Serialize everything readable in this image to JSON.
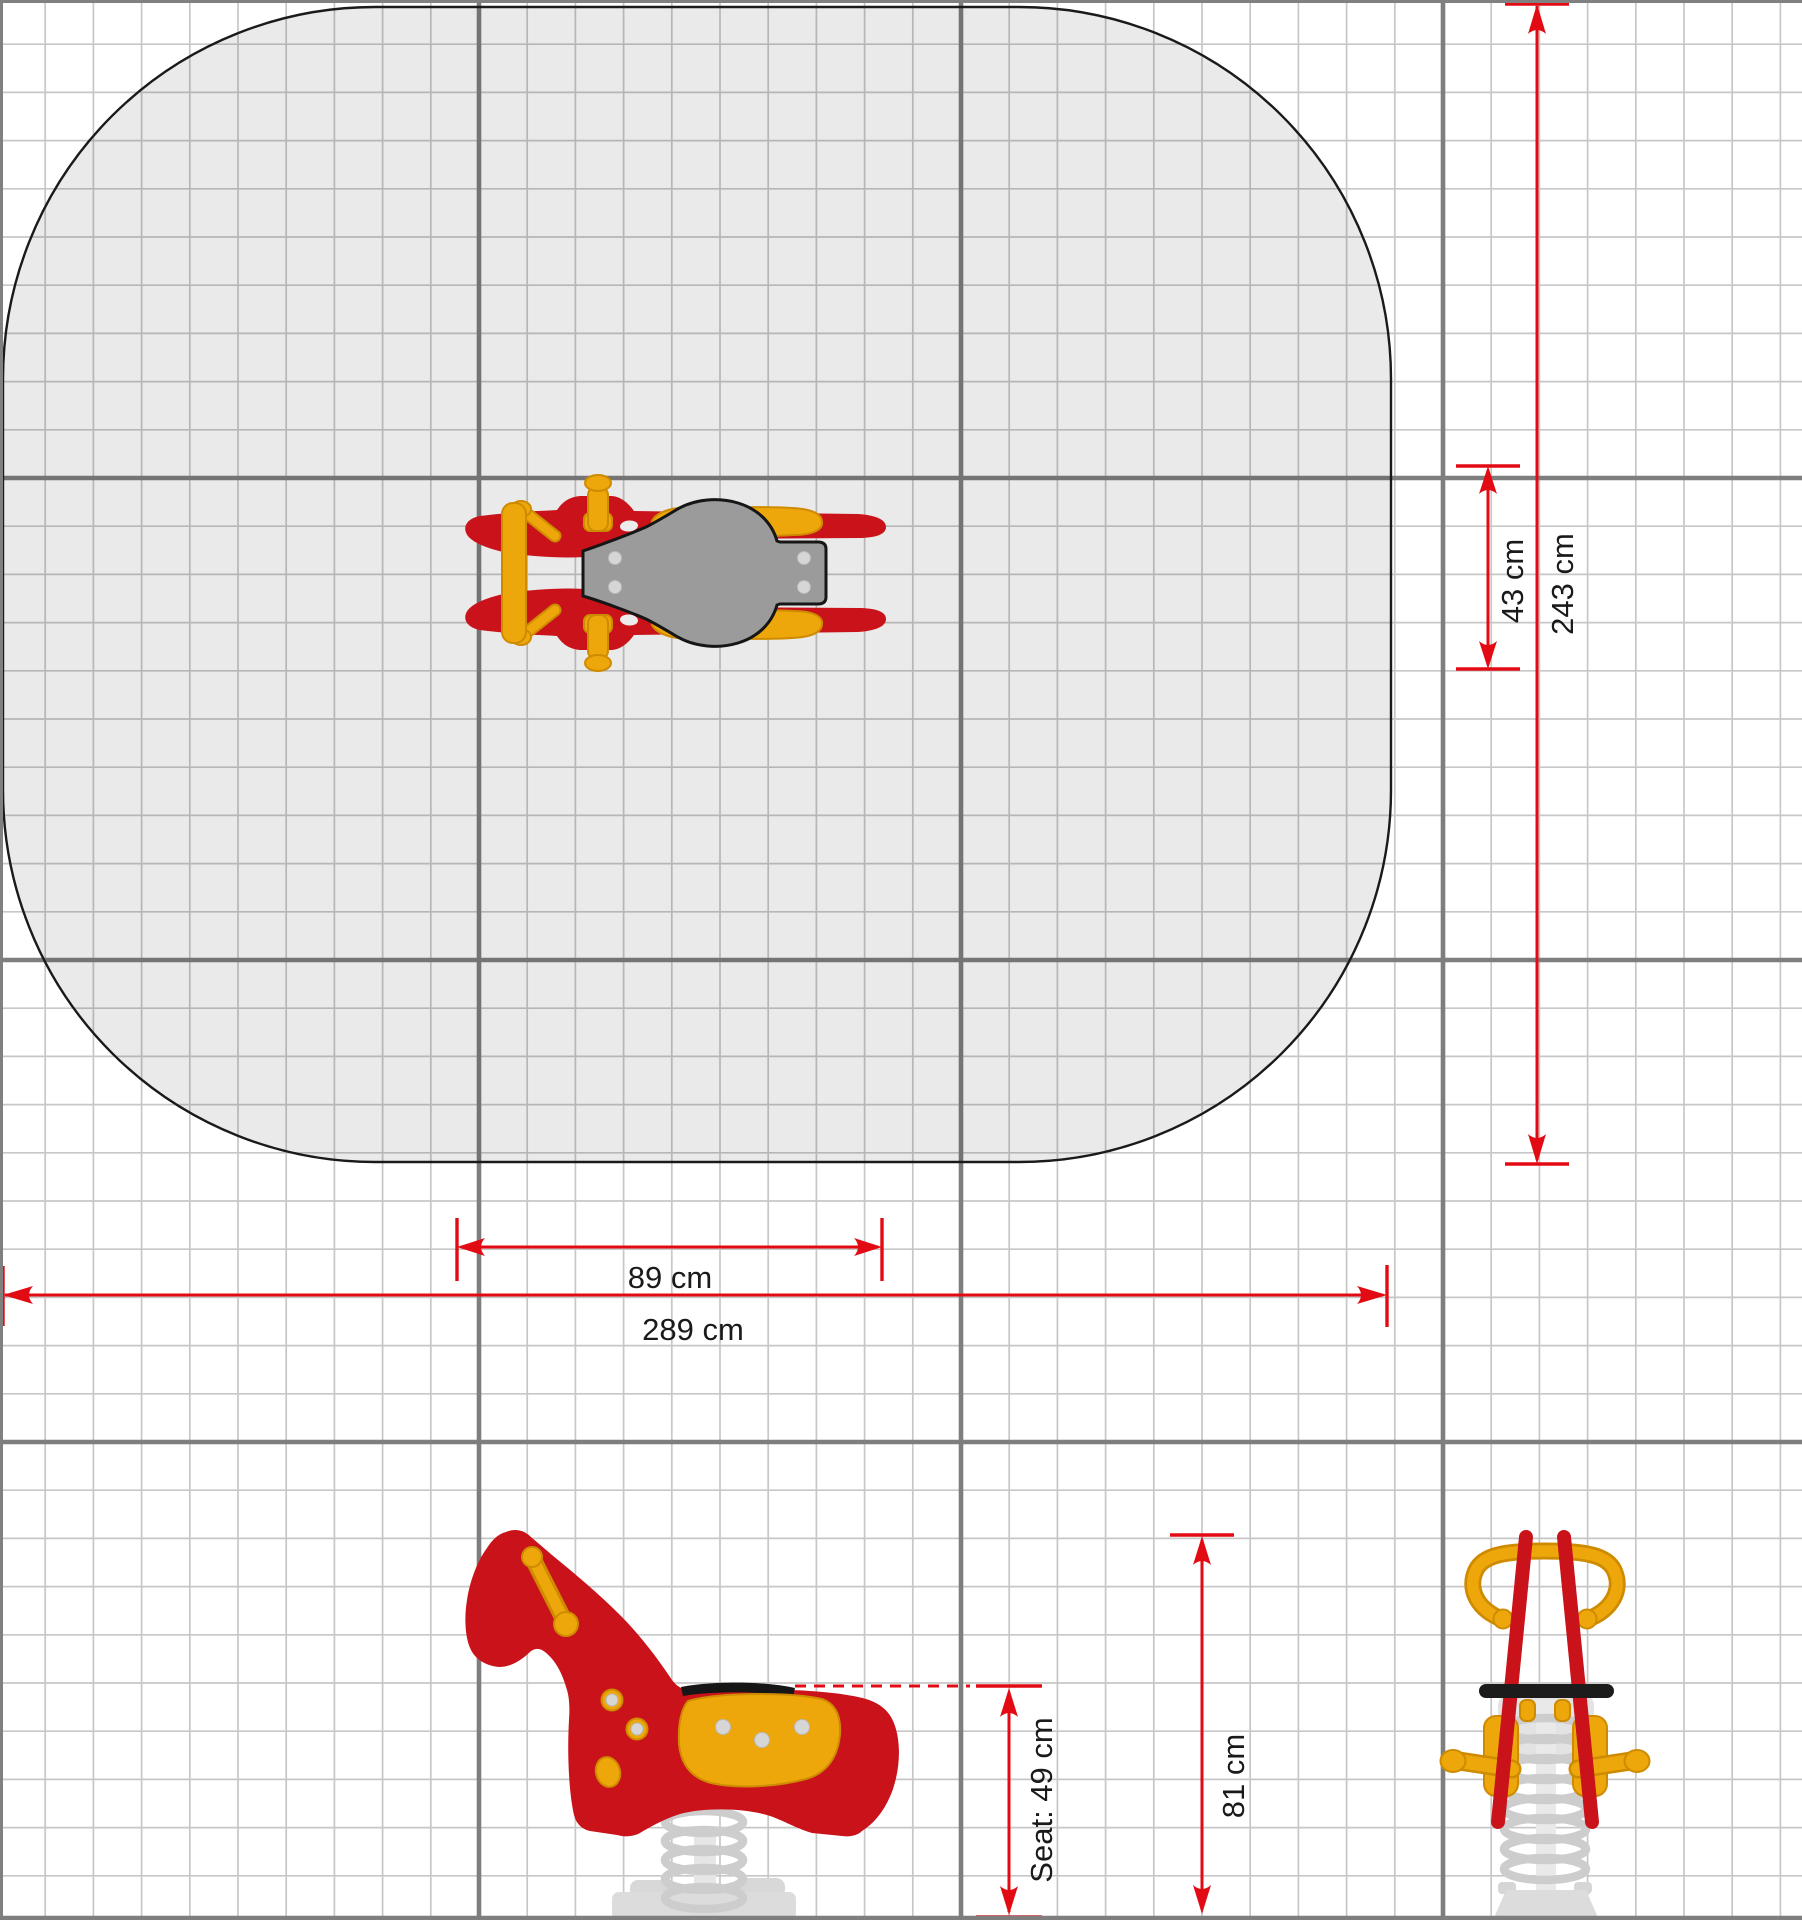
{
  "dimensions": {
    "device_width": {
      "label": "43 cm"
    },
    "zone_depth": {
      "label": "243 cm"
    },
    "device_length": {
      "label": "89 cm"
    },
    "zone_width": {
      "label": "289 cm"
    },
    "total_height": {
      "label": "81 cm"
    },
    "seat_height": {
      "label": "Seat: 49 cm"
    }
  },
  "views": {
    "top": "rocker-top-view-icon",
    "side": "rocker-side-view-icon",
    "front": "rocker-front-view-icon"
  },
  "colors": {
    "dimension_red": "#e30b13",
    "rocker_red": "#c9121a",
    "rocker_yellow": "#eda70a",
    "yellow_outline": "#cf8b00",
    "seat_black": "#1c1c1c",
    "plate_gray": "#9b9b9b",
    "safety_zone_fill": "#e9e9e9",
    "grid_minor": "#c7c7c7",
    "grid_major": "#7e7e7e",
    "spring_gray": "#cdcdcd",
    "faded_gray": "#dcdcdc"
  }
}
